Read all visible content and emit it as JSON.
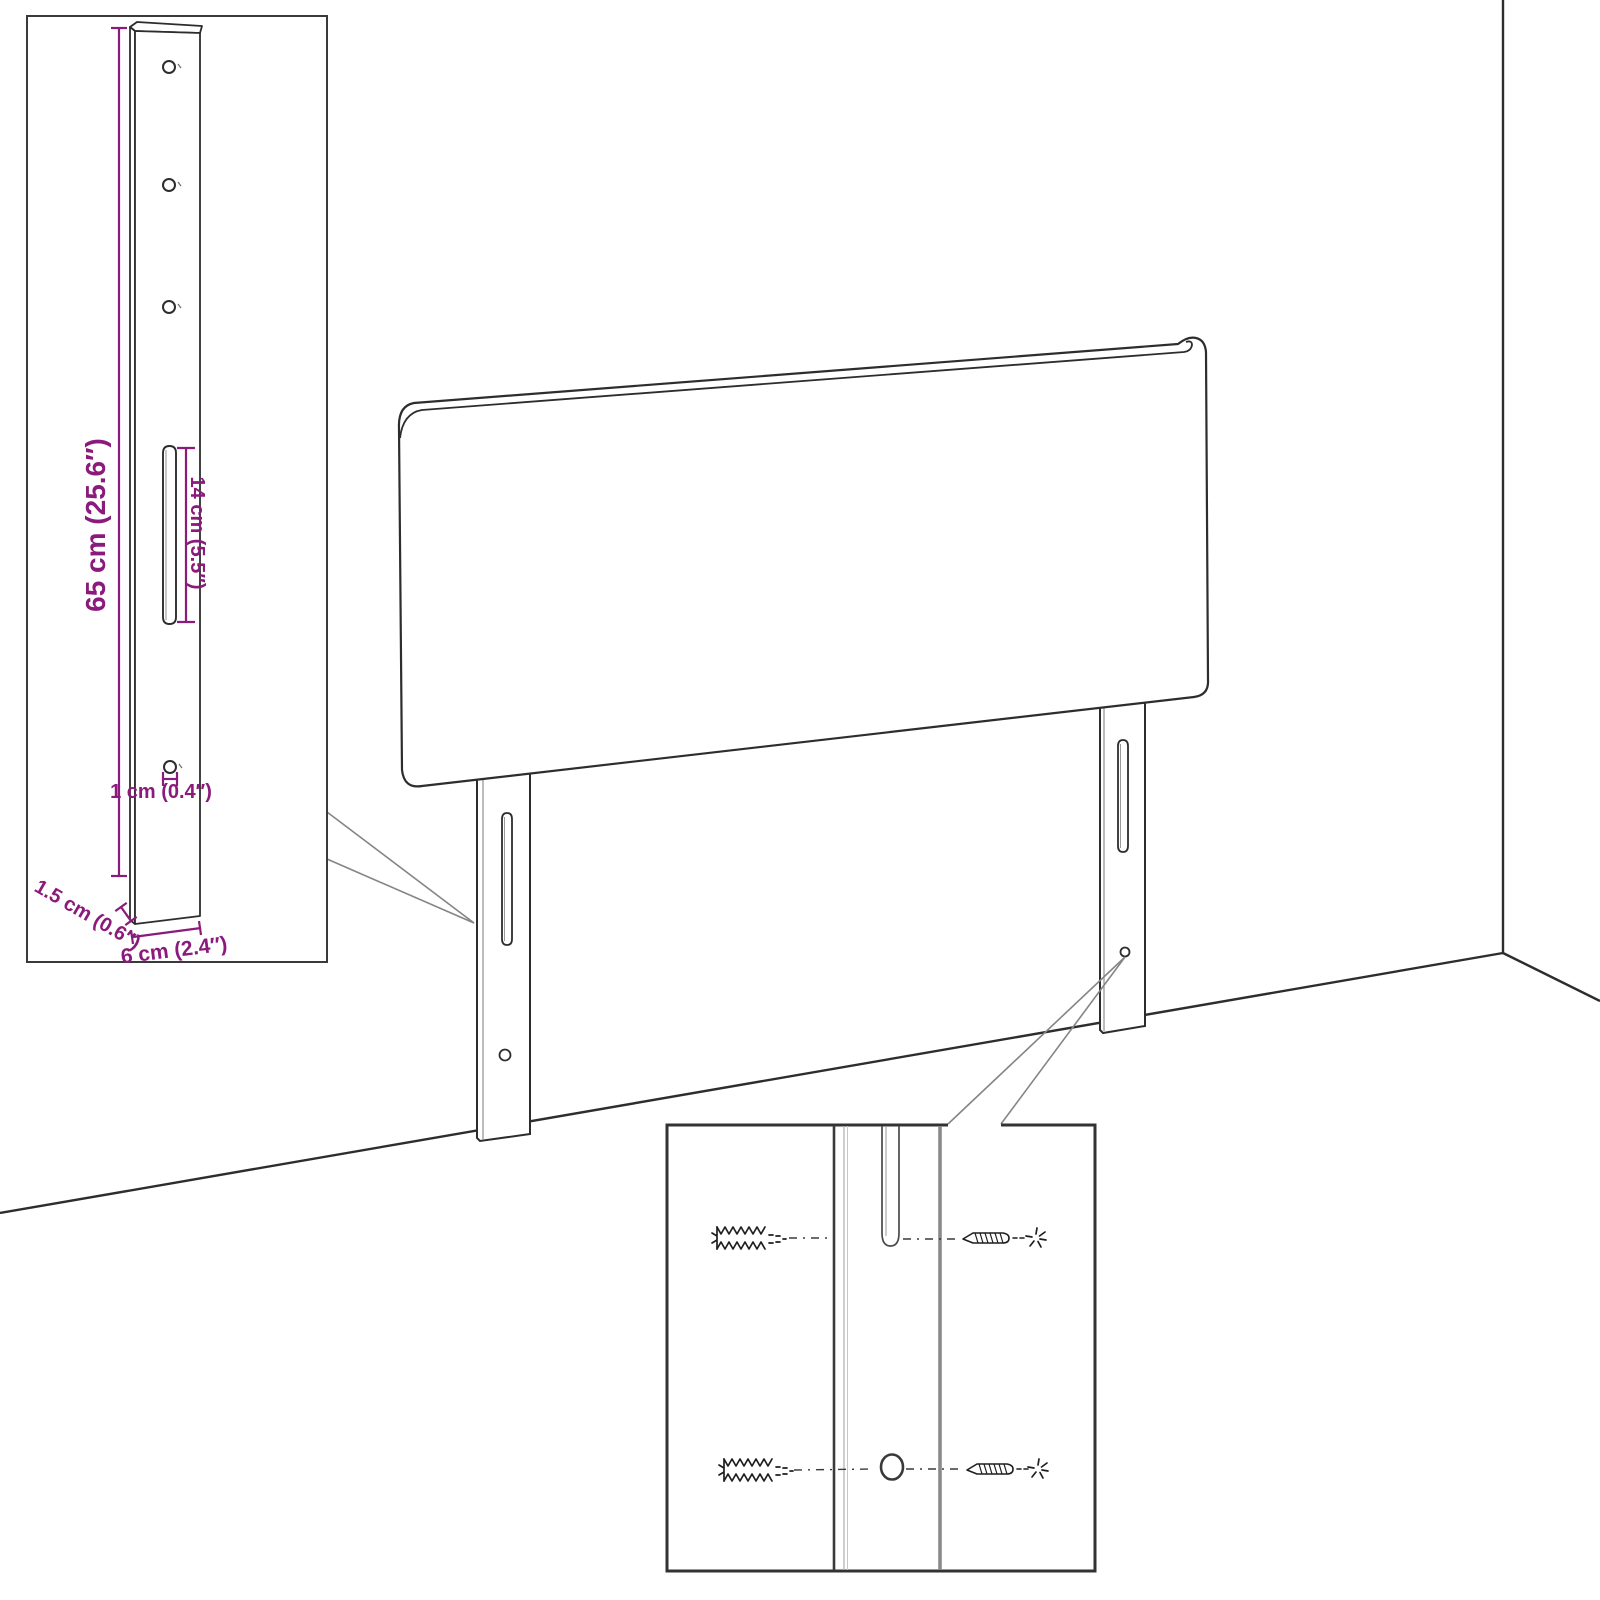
{
  "figure": {
    "type": "assembly-dimension-diagram",
    "subject": "upholstered headboard with two adjustable mounting legs shown in a room corner",
    "background_color": "#ffffff",
    "outline_color": "#2d2d2d",
    "accent_color": "#8A1A7B",
    "callout_line_color": "#858585",
    "inset_border_color": "#3a3a3a"
  },
  "dimensions": {
    "leg_height": "65 cm (25.6″)",
    "slot_length": "14 cm (5.5″)",
    "hole_diameter": "1 cm (0.4″)",
    "leg_thickness": "1.5 cm (0.6″)",
    "leg_width": "6 cm (2.4″)"
  },
  "insets": {
    "top_left": {
      "content": "single mounting leg with three upper holes, adjustment slot and lower screw hole, with dimension callouts"
    },
    "bottom_center": {
      "content": "magnified leg section with wall plugs and screws aligned to the slot and the lower hole"
    }
  },
  "icons": {
    "wall_plug": "wall-plug-icon",
    "screw": "screw-icon",
    "impact_star": "impact-star-icon"
  },
  "scene": {
    "elements": [
      "wall-corner-line",
      "floor-line",
      "headboard-panel",
      "left-leg",
      "right-leg",
      "callout-wedge-left",
      "callout-wedge-right"
    ]
  }
}
